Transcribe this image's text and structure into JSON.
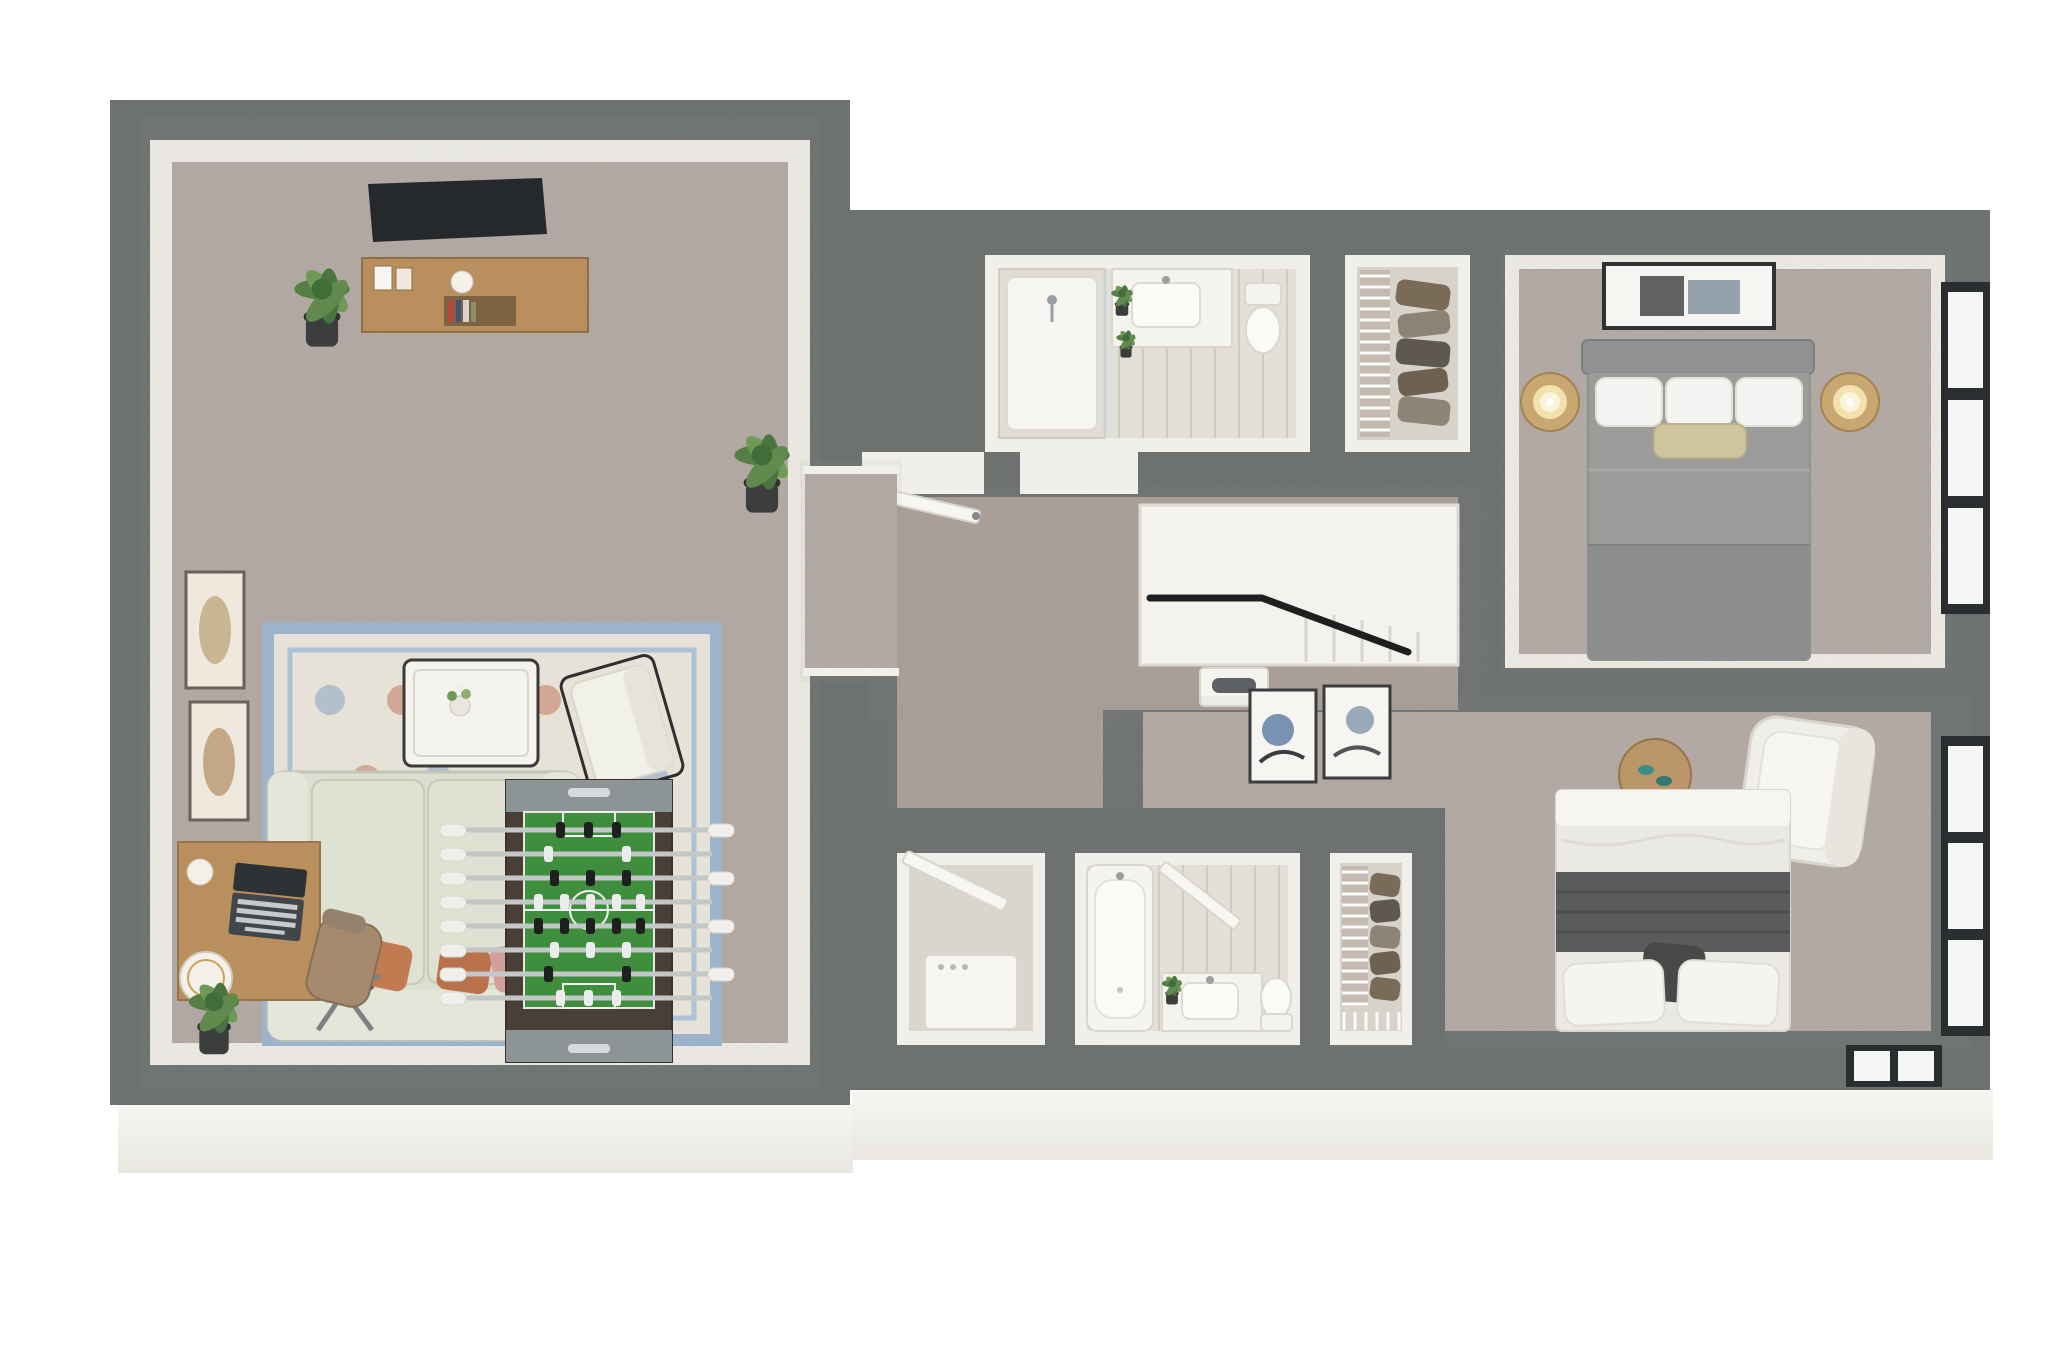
{
  "scene": {
    "type": "3d-floor-plan-render",
    "view": "top-down dollhouse cutaway",
    "rooms": [
      {
        "name": "rec-room",
        "floor": "carpet",
        "furniture": [
          "wall-mounted-tv",
          "media-console",
          "decor-frames",
          "decor-vase",
          "books",
          "potted-plant-left",
          "potted-plant-right",
          "framed-wall-art-upper",
          "framed-wall-art-lower",
          "area-rug",
          "loveseat-sofa",
          "pillow-navy",
          "pillow-rust",
          "pillow-rust-2",
          "pillow-blush",
          "coffee-table",
          "flower-vase",
          "accent-chair",
          "drum-side-table",
          "table-lamp",
          "writing-desk",
          "laptop",
          "desk-vase",
          "drum-stool",
          "office-chair",
          "potted-plant-corner",
          "foosball-table"
        ]
      },
      {
        "name": "hallway",
        "floor": "carpet",
        "features": [
          "door-to-hall",
          "opening-to-bathroom-1",
          "stairwell",
          "stair-handrail",
          "wall-niche-panel"
        ]
      },
      {
        "name": "bathroom-1",
        "floor": "tile",
        "fixtures": [
          "walk-in-shower",
          "shower-glass",
          "vanity-counter",
          "sink",
          "faucet",
          "vanity-plants",
          "toilet"
        ]
      },
      {
        "name": "closet-1",
        "type": "walk-in-closet",
        "features": [
          "wire-shelving",
          "hanging-clothes"
        ]
      },
      {
        "name": "bedroom-1",
        "floor": "carpet",
        "furniture": [
          "framed-art-above-bed",
          "headboard",
          "queen-bed-gray",
          "white-pillows",
          "accent-pillow-tan",
          "nightstand-left",
          "lamp-left",
          "nightstand-right",
          "lamp-right",
          "window-upper",
          "window-lower"
        ]
      },
      {
        "name": "utility-closet",
        "features": [
          "door-leaf",
          "water-heater"
        ]
      },
      {
        "name": "bathroom-2",
        "floor": "tile",
        "fixtures": [
          "bathtub",
          "door-leaf",
          "vanity-counter",
          "sink",
          "vanity-plant",
          "toilet"
        ]
      },
      {
        "name": "closet-2",
        "type": "walk-in-closet",
        "features": [
          "wire-shelving",
          "hanging-clothes",
          "corner-shelf"
        ]
      },
      {
        "name": "bedroom-2",
        "floor": "carpet",
        "furniture": [
          "framed-art-pair",
          "round-side-table",
          "shoes",
          "armchair",
          "queen-bed-white",
          "dark-blanket-band",
          "pillows",
          "folded-throw",
          "window-on-bottom-wall",
          "window-right"
        ]
      }
    ],
    "palette": {
      "wall": "#6d7271",
      "whiteFace": "#f1efe9",
      "carpet": "#b5aba6",
      "hallCarpet": "#aba09a",
      "tile": "#e3e0d8",
      "closetFloor": "#d8d3ca",
      "stairFloor": "#f3f2ec",
      "foundation": "#f7f6f2",
      "wood": "#b98f5d",
      "woodDark": "#97744a",
      "tv": "#26292b",
      "rugField": "#e7e2d7",
      "rugBorder": "#9db3cc",
      "rugAccent": "#c3806a",
      "sofa": "#dbded0",
      "sofaTrim": "#c2c6b6",
      "navy": "#3f5273",
      "rust": "#c27a50",
      "blush": "#d0a09c",
      "leaf": "#567f45",
      "leafLight": "#6f9a55",
      "pot": "#3b3e3d",
      "foosballBody": "#4a3f37",
      "foosballCap": "#8d9496",
      "foosballField": "#3e8e3e",
      "rod": "#c3c7c9",
      "playerBlack": "#1f1f1f",
      "playerWhite": "#ececec",
      "bedGray": "#9c9c9a",
      "bedGrayDark": "#8b8e8d",
      "headboard": "#8f9192",
      "pillowWhite": "#f4f4f2",
      "accentPillow": "#cfc49c",
      "bed2White": "#ebe9e4",
      "bed2Band": "#5a5c5c",
      "bed2Lump": "#474949",
      "fixtureWhite": "#f6f5f1",
      "fixtureEdge": "#d9d7ce",
      "chrome": "#9aa0a2",
      "windowFrame": "#2b2e30",
      "windowPane": "#f5f7f7",
      "handrail": "#1d1f20",
      "glow": "#f3e2ae",
      "clothes1": "#7a6a58",
      "clothes2": "#8d8376",
      "clothes3": "#5f584e",
      "teal": "#3f8e86"
    }
  }
}
